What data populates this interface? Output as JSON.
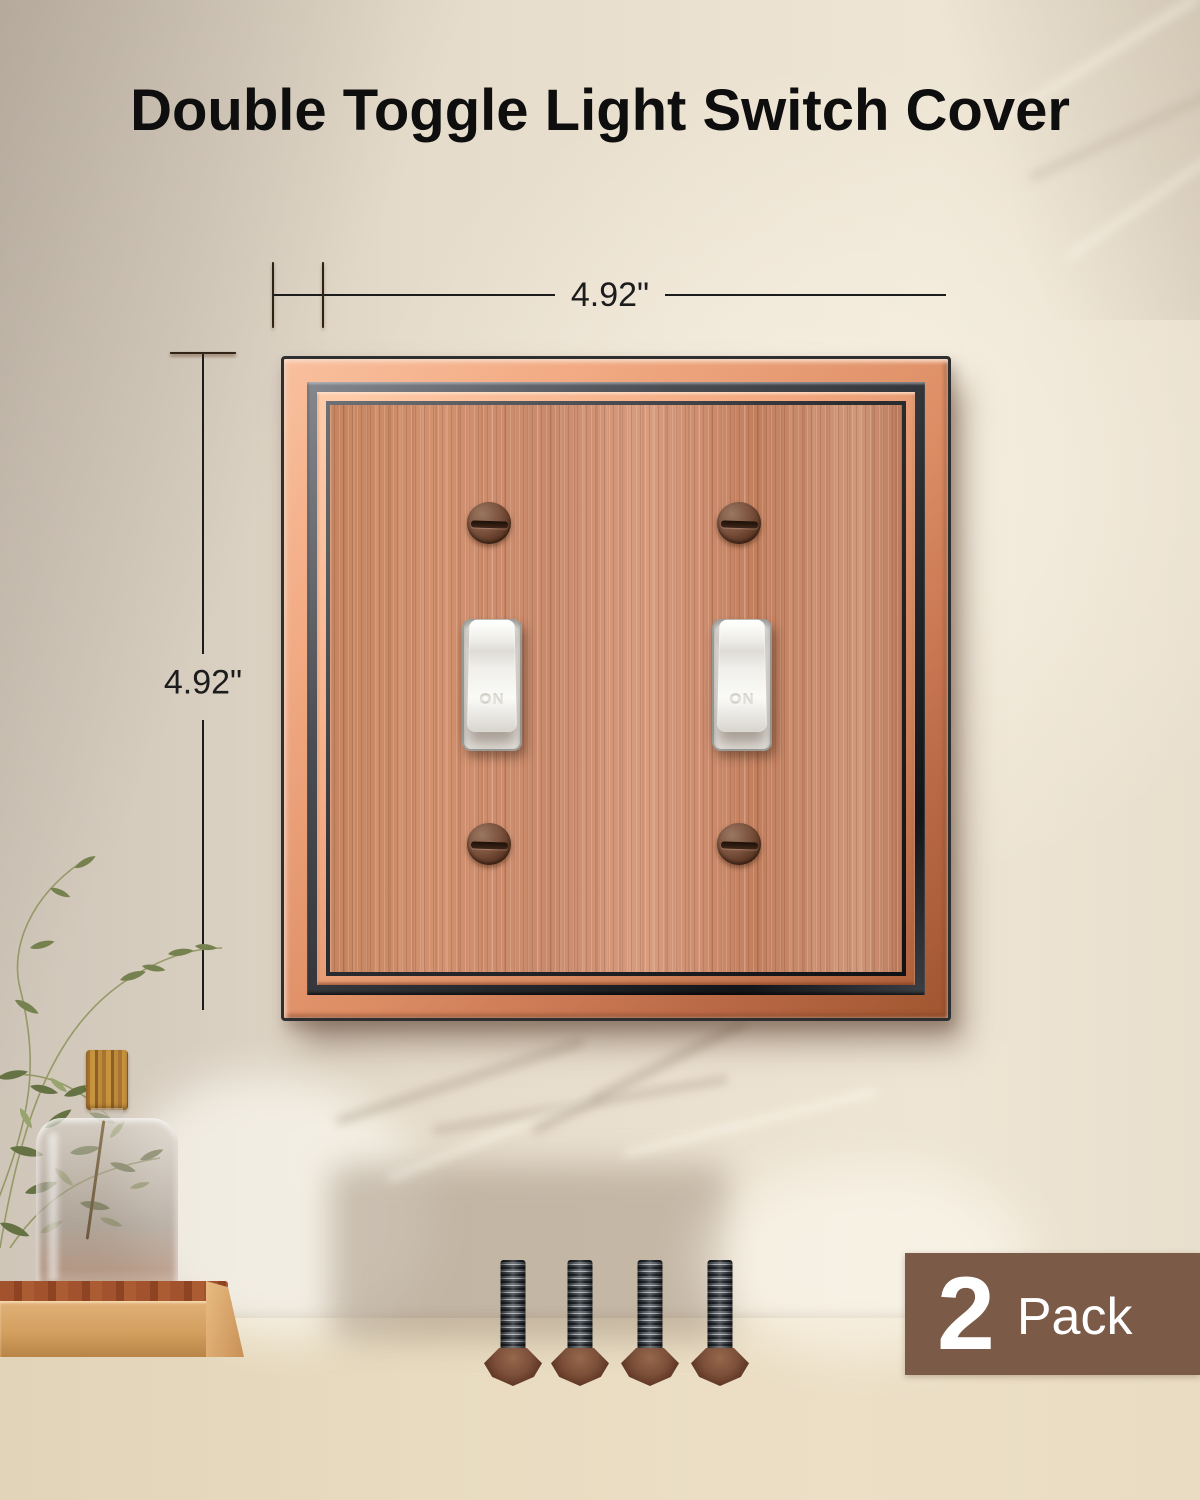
{
  "title": "Double Toggle Light Switch Cover",
  "dimension_labels": {
    "width": "4.92\"",
    "height": "4.92\""
  },
  "plate": {
    "type": "double-toggle-wall-plate",
    "toggles": [
      {
        "label": "ON"
      },
      {
        "label": "ON"
      }
    ],
    "screw_count": 4,
    "colors": {
      "face_copper": "#c98a6c",
      "frame_copper": "#e08f67",
      "frame_dark": "#3b3e43",
      "toggle_white": "#f4f3ef",
      "screw_bronze": "#6d4a39"
    }
  },
  "hardware": {
    "screw_count": 4,
    "screw_color": "#4a3a30"
  },
  "badge": {
    "count": "2",
    "unit": "Pack",
    "background": "#7b5a48",
    "text_color": "#ffffff"
  },
  "scene": {
    "wall_color": "#e7ddcc",
    "table_color": "#e9dcc1",
    "dimension_line_color": "#1c1c1c",
    "title_color": "#0e0e0e"
  }
}
